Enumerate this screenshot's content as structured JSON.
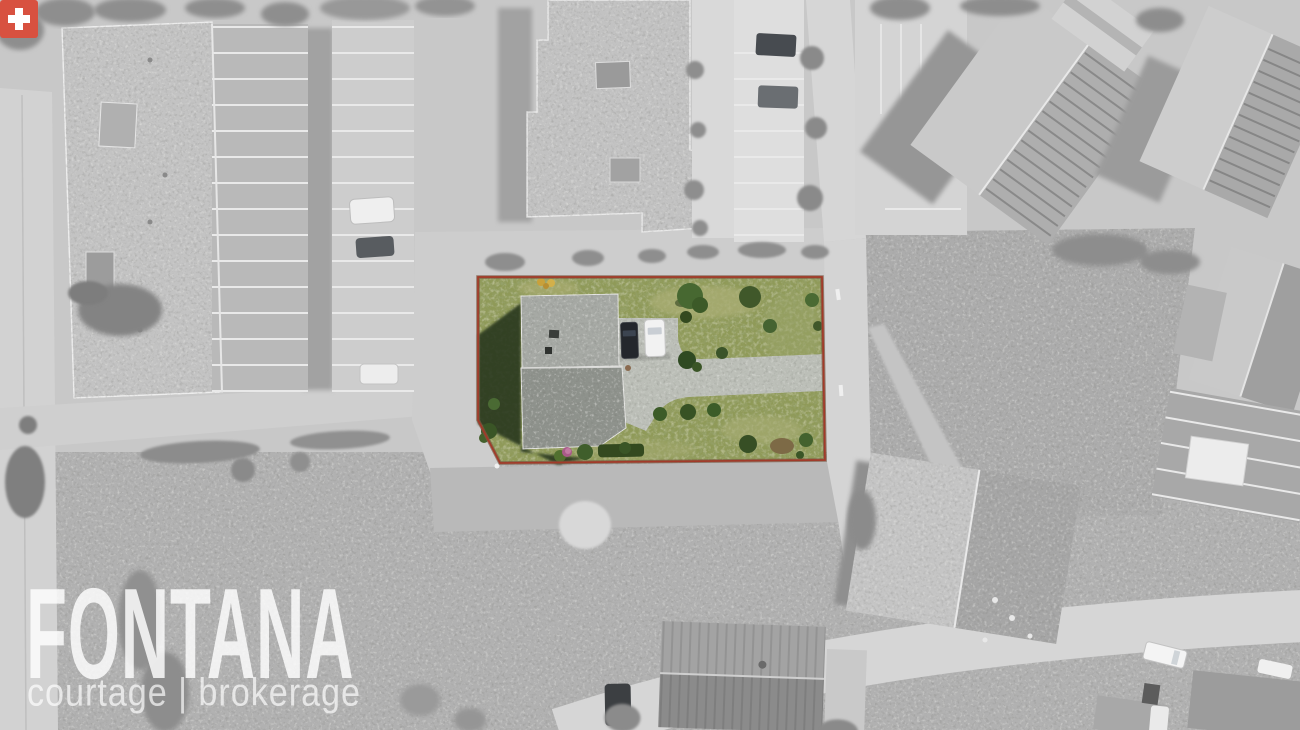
{
  "watermark": {
    "brand": "FONTANA",
    "tagline": "courtage | brokerage",
    "flag_icon": "swiss-cross-icon"
  },
  "colors": {
    "swiss_cross_red": "#d85140",
    "parcel_boundary_red": "#a23a29",
    "parcel_hedge_brown": "#7a5742",
    "parcel_grass_green": "#8f9a59",
    "roof_gray_upper": "#a6a9a4",
    "roof_gray_lower": "#8e928c",
    "driveway_gray": "#bcbfb8",
    "car_dark": "#24272c",
    "car_white": "#f2f2f2",
    "monochrome_base": "#c8c8c8"
  }
}
